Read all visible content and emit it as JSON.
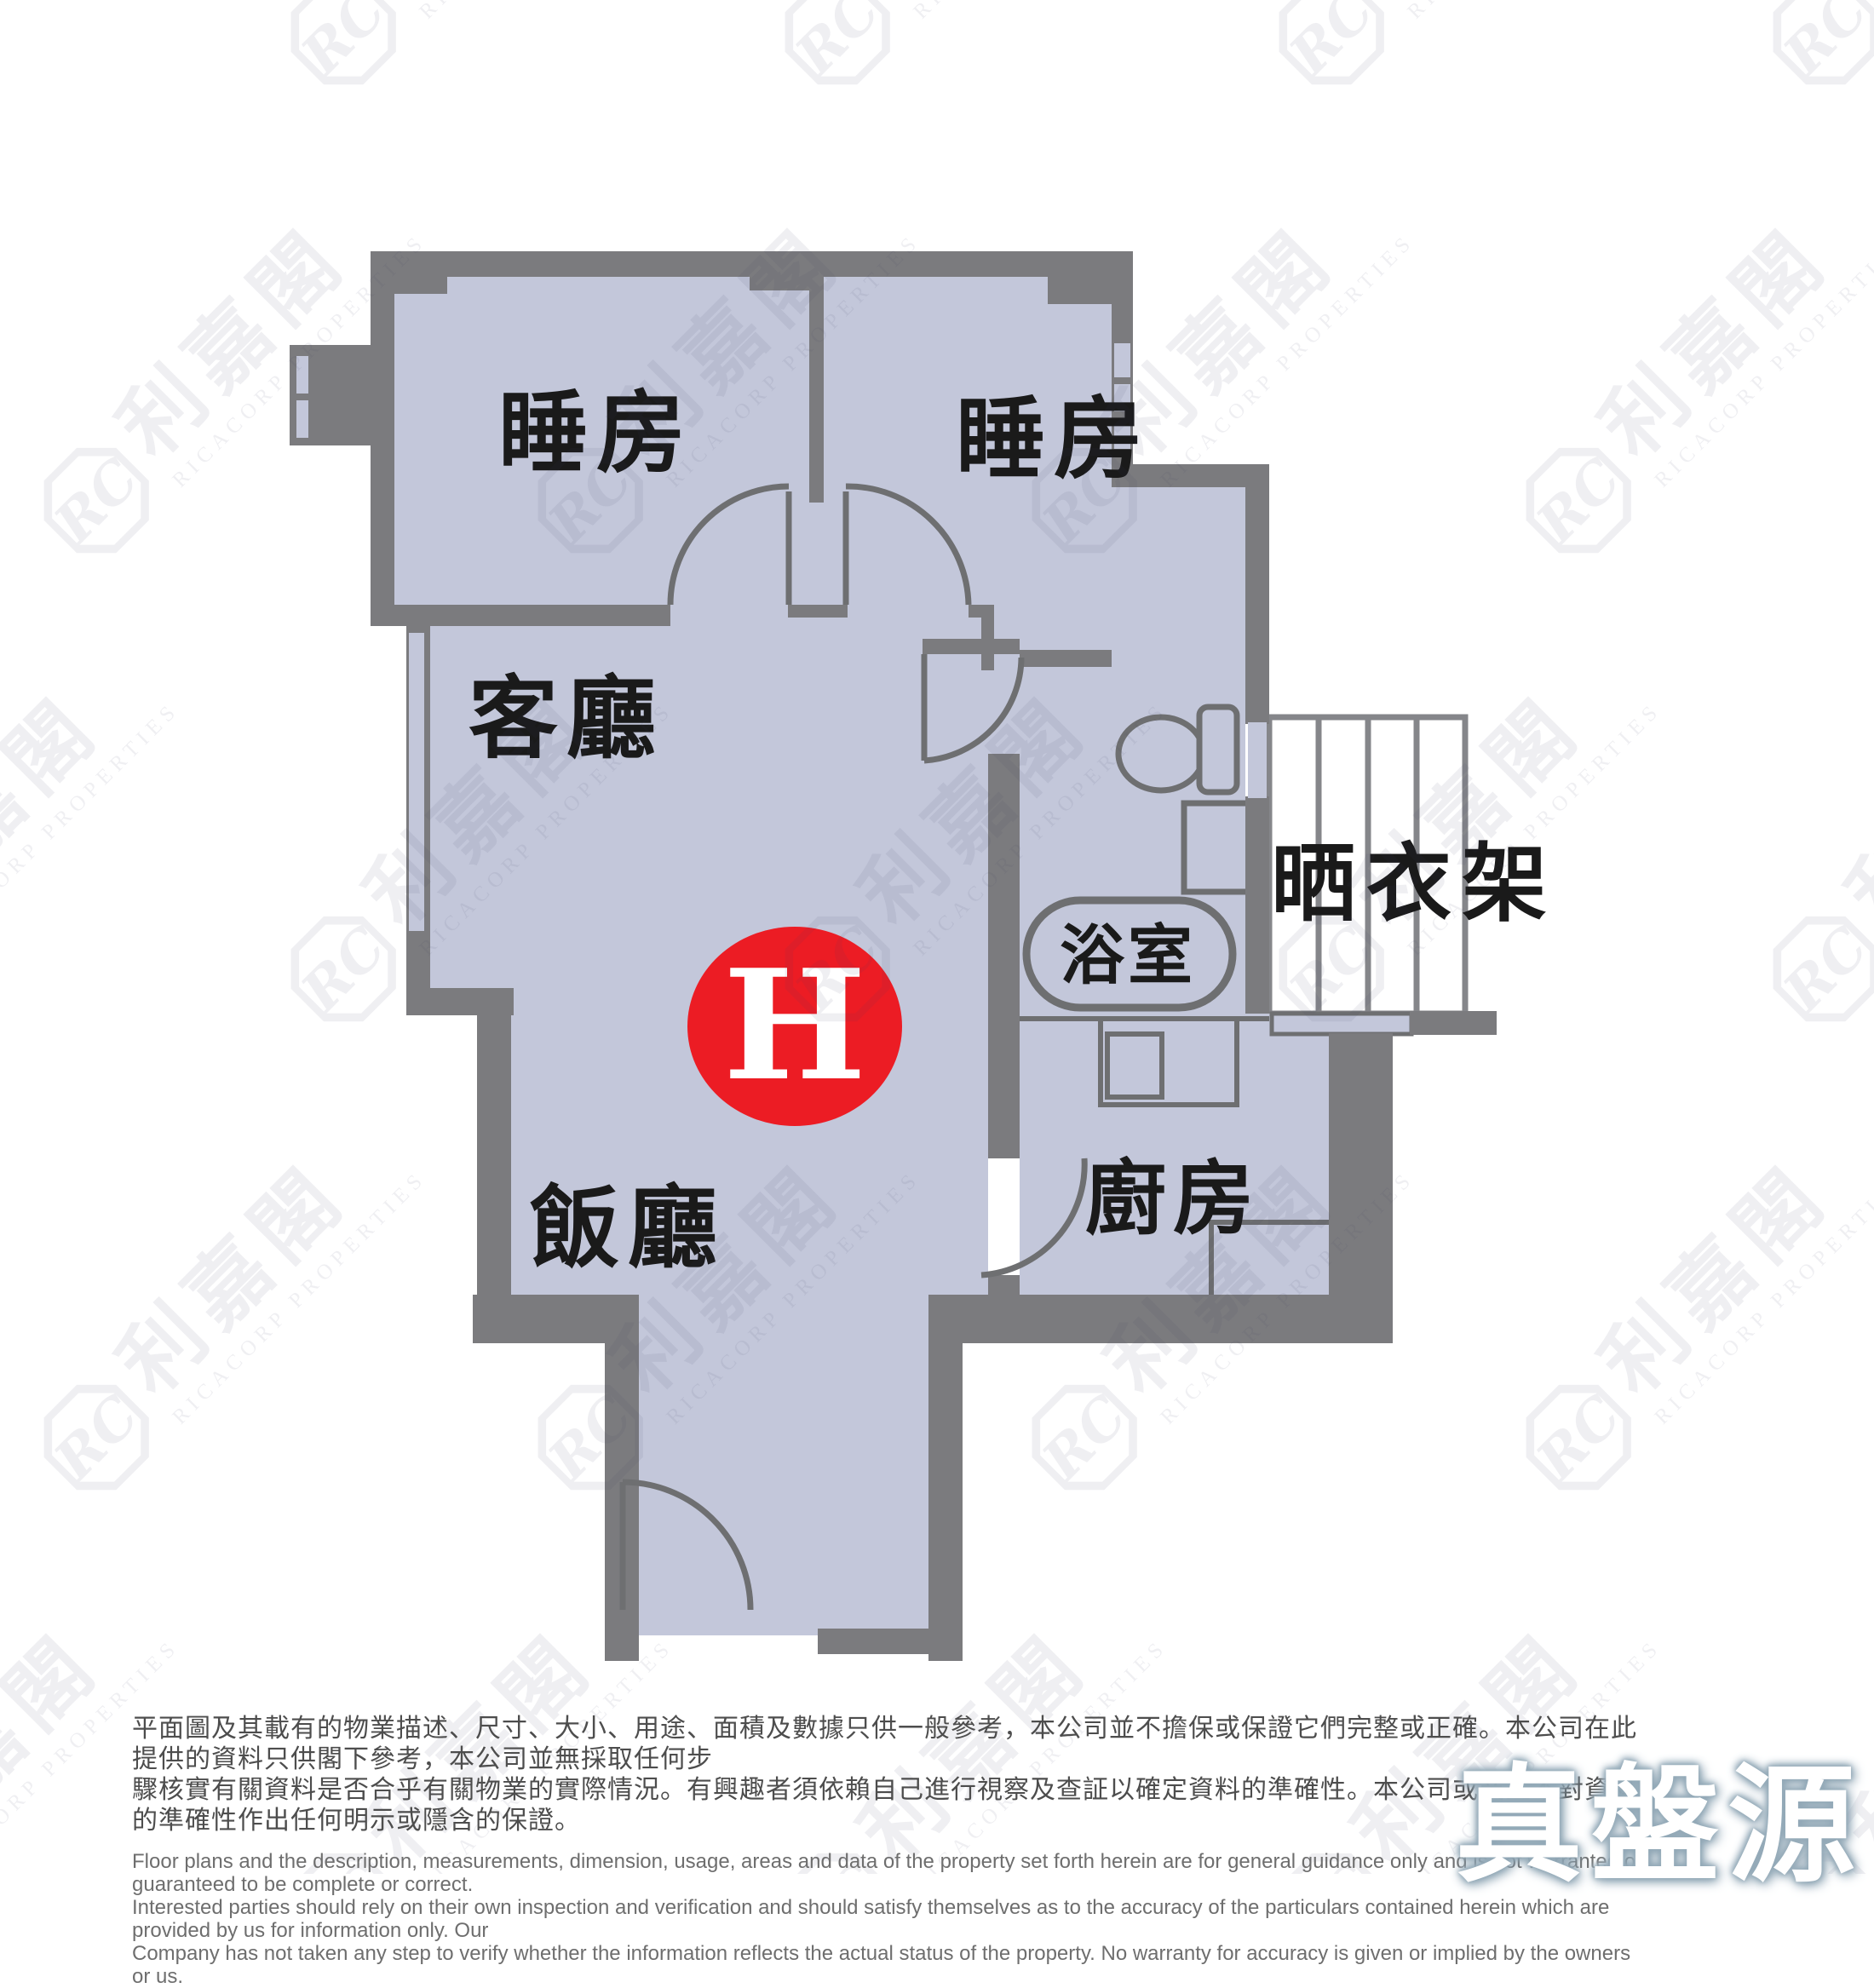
{
  "floor_plan": {
    "unit_badge": "H",
    "rooms": {
      "bedroom1": "睡房",
      "bedroom2": "睡房",
      "living": "客廳",
      "dining": "飯廳",
      "bathroom": "浴室",
      "kitchen": "廚房",
      "drying_rack": "晒衣架"
    },
    "colors": {
      "wall": "#7b7b7e",
      "room": "#c3c7da",
      "line": "#6e6f71",
      "rack_line": "#85868a",
      "badge": "#ec1c24"
    }
  },
  "watermark": {
    "logo_initials": "RC",
    "brand_cn": "利嘉閣",
    "brand_en": "RICACORP PROPERTIES"
  },
  "footer": {
    "disclaimer_cn": [
      "平面圖及其載有的物業描述、尺寸、大小、用途、面積及數據只供一般參考，本公司並不擔保或保證它們完整或正確。本公司在此提供的資料只供閣下參考，本公司並無採取任何步",
      "驟核實有關資料是否合乎有關物業的實際情況。有興趣者須依賴自己進行視察及查証以確定資料的準確性。本公司或業主不對資料的準確性作出任何明示或隱含的保證。"
    ],
    "disclaimer_en": [
      "Floor plans and the description, measurements, dimension, usage, areas and data of the property set forth herein are for general guidance only and is not warranted or guaranteed to be complete or correct.",
      "Interested parties should rely on their own inspection and verification and should satisfy themselves as to the accuracy of the particulars contained herein which are provided by us for information only.  Our",
      "Company has not taken any step to verify whether the information reflects the actual status of the property.  No warranty for accuracy is given or implied by the owners or us."
    ],
    "source_logo": "真盤源"
  }
}
